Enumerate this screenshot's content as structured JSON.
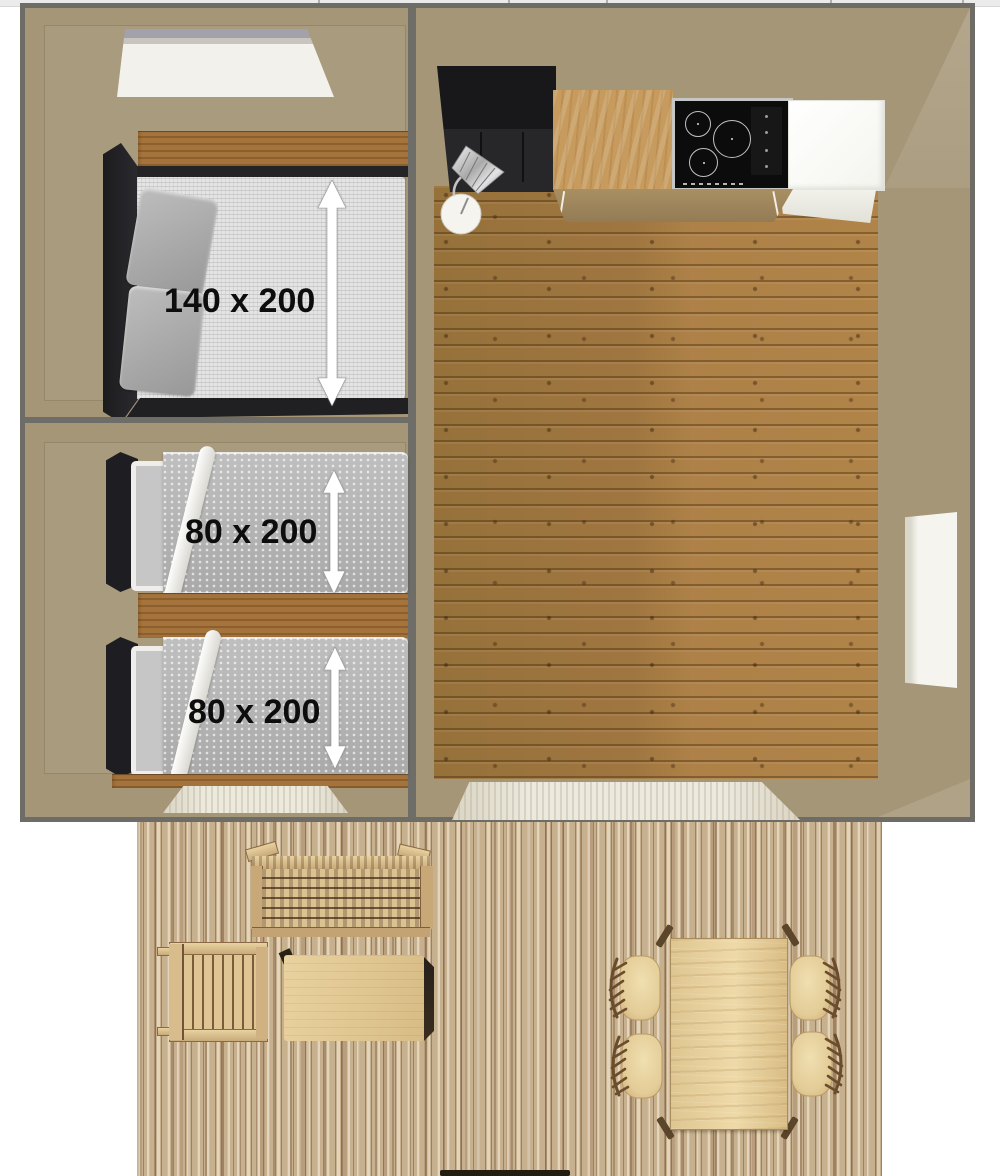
{
  "plan": {
    "bedroom_double": {
      "dimension_label": "140 x 200",
      "objects": [
        "skylight-window",
        "double-bed",
        "pillows",
        "dimension-arrow"
      ]
    },
    "bedroom_twin": {
      "beds": [
        {
          "dimension_label": "80 x 200"
        },
        {
          "dimension_label": "80 x 200"
        }
      ],
      "objects": [
        "single-bed-top",
        "single-bed-bottom",
        "door-threshold",
        "dimension-arrows"
      ]
    },
    "living_room": {
      "objects": [
        "kitchen-sink-unit",
        "floor-lamp",
        "kitchen-counter",
        "induction-hob",
        "white-cabinet",
        "side-window",
        "patio-door-threshold",
        "wood-plank-floor"
      ]
    },
    "terrace": {
      "objects": [
        "slatted-bench",
        "slatted-armchair",
        "coffee-table",
        "dining-table",
        "dining-chairs",
        "step-shadow"
      ]
    }
  },
  "colors": {
    "wall_tan": "#a59678",
    "border_grey": "#6e6c66",
    "wood_floor": "#a37a40",
    "wood_strip": "#8d5f2c",
    "deck_light": "#d7c5a7",
    "deck_dark": "#8f7459",
    "bed_frame_black": "#232326",
    "mattress_grey": "#e4e4e4",
    "duvet_grey": "#b5b5b5",
    "pillow_grey": "#a3a3a3",
    "kitchen_black": "#1a1a1c",
    "counter_oak": "#c79b5d",
    "cabinet_white": "#fbfbf7",
    "window_white": "#f4f3ee",
    "label_text": "#0d0d0d",
    "arrow_white": "#ffffff"
  }
}
